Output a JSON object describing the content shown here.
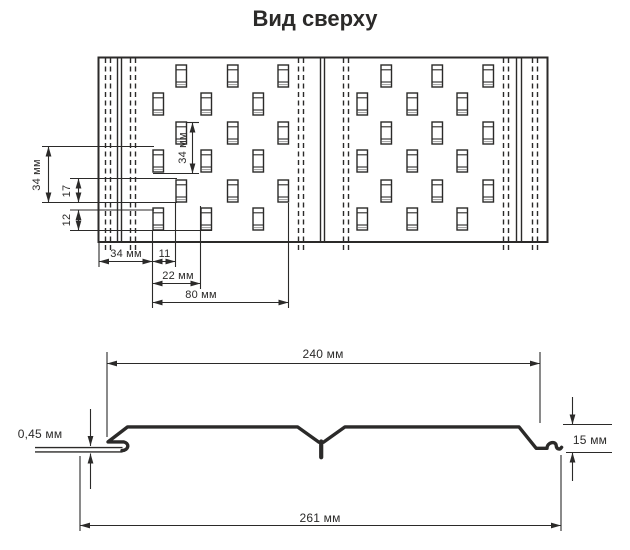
{
  "title": "Вид сверху",
  "colors": {
    "line": "#2b2a29",
    "background": "#ffffff",
    "slot_shade": "#9c9c9c"
  },
  "top_view": {
    "panel": {
      "x": 98.5,
      "y": 57.5,
      "width": 449,
      "height": 184.5
    },
    "solid_lines_x": [
      117.5,
      121.5,
      320.5,
      324.5,
      516.5,
      521.5
    ],
    "dashed_lines_x": [
      105.5,
      110.5,
      130.5,
      135.5,
      298.5,
      303.5,
      343.5,
      348.5,
      503.5,
      508.5,
      532.5,
      537.5
    ],
    "slot": {
      "width": 10.5,
      "height": 22
    },
    "row_y": [
      65,
      93,
      122,
      150,
      180,
      208
    ],
    "sections": [
      {
        "rows_odd_x": [
          176,
          227.5,
          278
        ],
        "rows_even_x": [
          153,
          201,
          253
        ]
      },
      {
        "rows_odd_x": [
          381,
          432,
          483
        ],
        "rows_even_x": [
          357,
          407,
          457
        ]
      }
    ],
    "dimensions": {
      "margin_left": "34 мм",
      "offset_17": "17",
      "slot_height_12": "12",
      "row_pitch_34": "34 мм",
      "bottom_margin_34": "34 мм",
      "bottom_offset_11": "11",
      "bottom_22": "22 мм",
      "bottom_80": "80 мм"
    }
  },
  "profile_view": {
    "dimensions": {
      "width_240": "240 мм",
      "thickness_045": "0,45 мм",
      "height_15": "15 мм",
      "total_width_261": "261 мм"
    }
  }
}
